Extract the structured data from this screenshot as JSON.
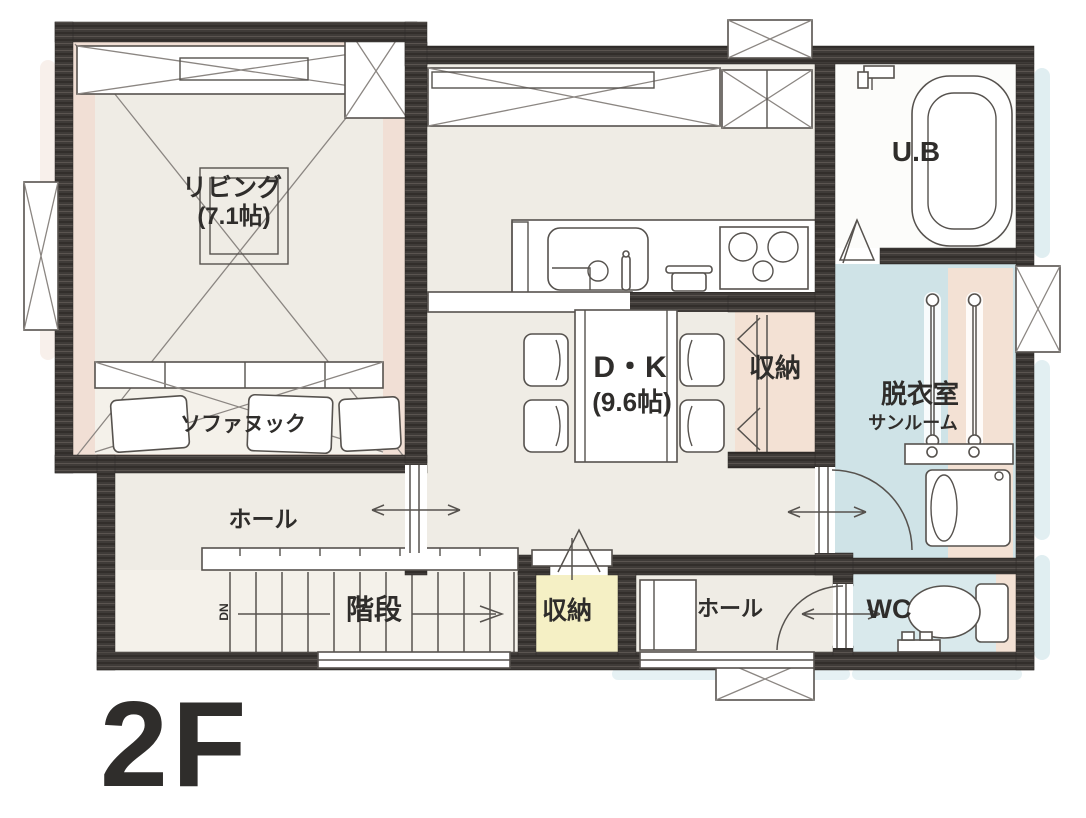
{
  "floor_label": "2F",
  "rooms": {
    "living": {
      "name": "リビング",
      "size": "(7.1帖)"
    },
    "sofa_nook": {
      "name": "ソファヌック"
    },
    "dining_kitchen": {
      "name": "D・K",
      "size": "(9.6帖)"
    },
    "storage_east": {
      "name": "収納"
    },
    "unit_bath": {
      "name": "U.B"
    },
    "dressing_room": {
      "name": "脱衣室",
      "sub": "サンルーム"
    },
    "hall_west": {
      "name": "ホール"
    },
    "stairs": {
      "name": "階段",
      "direction": "DN"
    },
    "storage_center": {
      "name": "収納"
    },
    "hall_east": {
      "name": "ホール"
    },
    "wc": {
      "name": "WC"
    }
  },
  "colors": {
    "wall": "#3f3b38",
    "living_accent": "#f1dfd5",
    "floor_cream": "#efece5",
    "floor_cream_light": "#f4f1ea",
    "storage_pink": "#f3e1d4",
    "dressing_blue": "#cfe3e7",
    "wc_blue": "#d9e9ec",
    "storage_yellow": "#f5f0c5",
    "bath_white": "#fcfcfa",
    "shadow_blue": "#d6e8ec",
    "ink": "#2c2c2c"
  }
}
